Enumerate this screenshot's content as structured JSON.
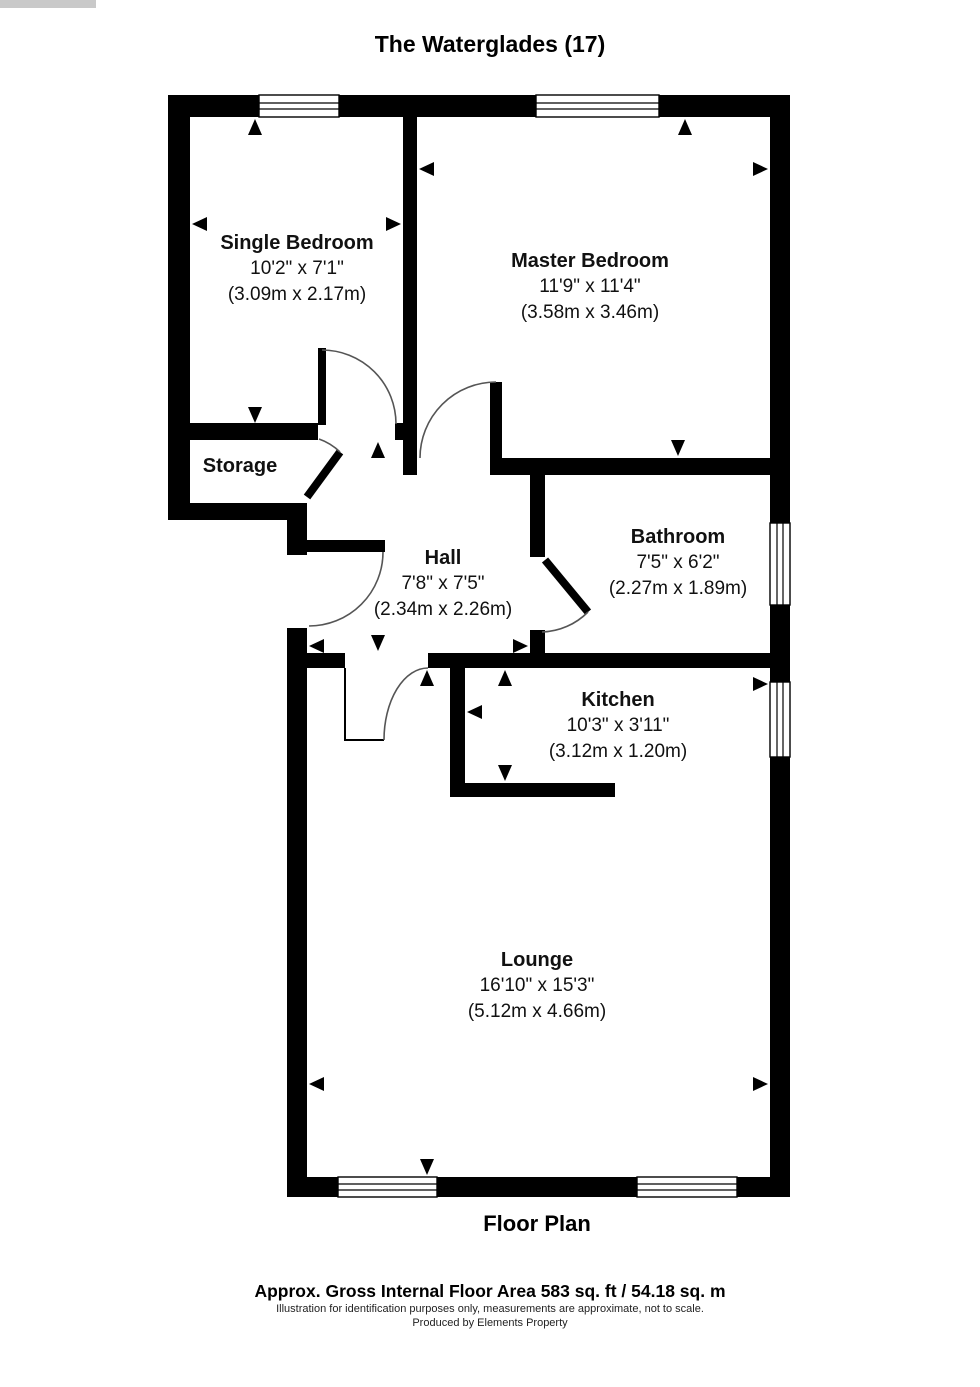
{
  "title": "The Waterglades (17)",
  "plan_label": "Floor Plan",
  "footer": {
    "area": "Approx. Gross Internal Floor Area 583 sq. ft / 54.18 sq. m",
    "disclaimer": "Illustration for identification purposes only, measurements are approximate, not to scale.",
    "producer": "Produced by Elements Property"
  },
  "rooms": {
    "single_bedroom": {
      "name": "Single Bedroom",
      "imperial": "10'2\" x 7'1\"",
      "metric": "(3.09m x 2.17m)"
    },
    "master_bedroom": {
      "name": "Master Bedroom",
      "imperial": "11'9\" x 11'4\"",
      "metric": "(3.58m x 3.46m)"
    },
    "storage": {
      "name": "Storage"
    },
    "hall": {
      "name": "Hall",
      "imperial": "7'8\" x 7'5\"",
      "metric": "(2.34m x 2.26m)"
    },
    "bathroom": {
      "name": "Bathroom",
      "imperial": "7'5\" x 6'2\"",
      "metric": "(2.27m x 1.89m)"
    },
    "kitchen": {
      "name": "Kitchen",
      "imperial": "10'3\" x 3'11\"",
      "metric": "(3.12m x 1.20m)"
    },
    "lounge": {
      "name": "Lounge",
      "imperial": "16'10\" x 15'3\"",
      "metric": "(5.12m x 4.66m)"
    }
  },
  "colors": {
    "wall": "#000000",
    "background": "#ffffff"
  }
}
